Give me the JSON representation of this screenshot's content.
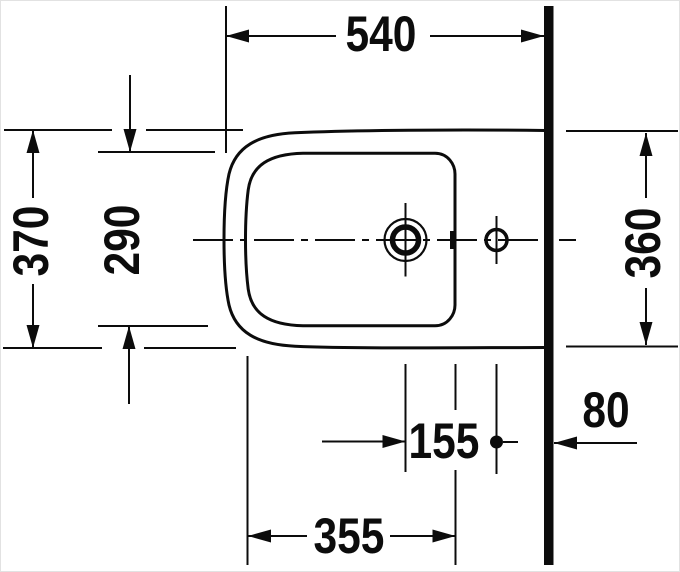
{
  "drawing": {
    "description": "technical top-view dimension drawing of a wall-side bidet with tap hole and drain",
    "line_color": "#0c0c0c",
    "background_color": "#ffffff",
    "dimensions": {
      "overall_depth_front_to_wall": "540",
      "overall_width": "370",
      "bowl_inner_width": "290",
      "width_at_wall": "360",
      "drain_to_tap_hole": "155",
      "tap_hole_to_wall": "80",
      "bowl_inner_length": "355"
    }
  }
}
